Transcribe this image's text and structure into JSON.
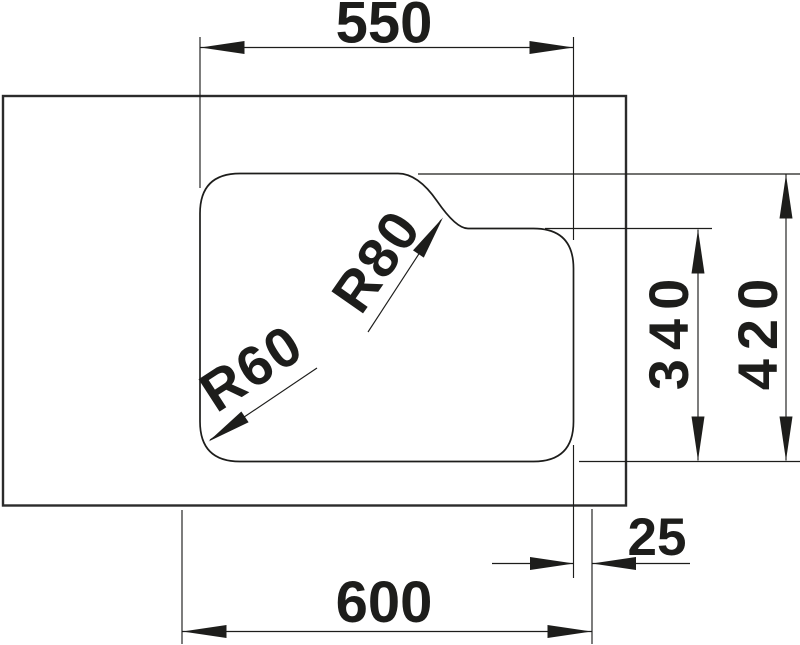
{
  "drawing": {
    "colors": {
      "background": "#ffffff",
      "line": "#1d1d1b"
    },
    "dimensions": {
      "top_width": "550",
      "bottom_width": "600",
      "right_offset": "25",
      "inner_height": "340",
      "overall_height": "420"
    },
    "radii": {
      "corner_label": "R60",
      "notch_label": "R80"
    }
  }
}
